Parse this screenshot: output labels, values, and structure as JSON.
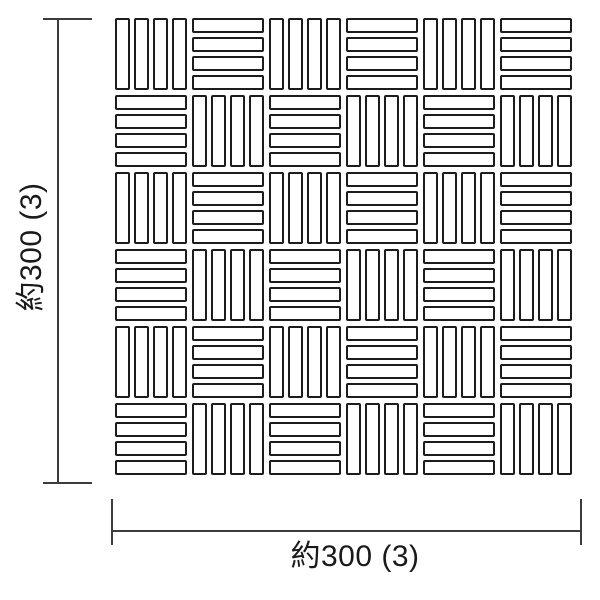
{
  "page": {
    "background": "#ffffff",
    "description_colors": {
      "tile_fill": "#ffffff",
      "tile_border": "#1c1c1c",
      "dimension_line": "#3c3c3c",
      "text": "#1a1a1a"
    }
  },
  "pattern": {
    "grid": {
      "rows": 6,
      "cols": 6,
      "bars_per_block": 4,
      "first_block_orientation": "vertical",
      "layout": "checkerboard-basketweave"
    }
  },
  "dimensions": {
    "width": {
      "label": "約300 (3)"
    },
    "height": {
      "label": "約300 (3)"
    }
  }
}
